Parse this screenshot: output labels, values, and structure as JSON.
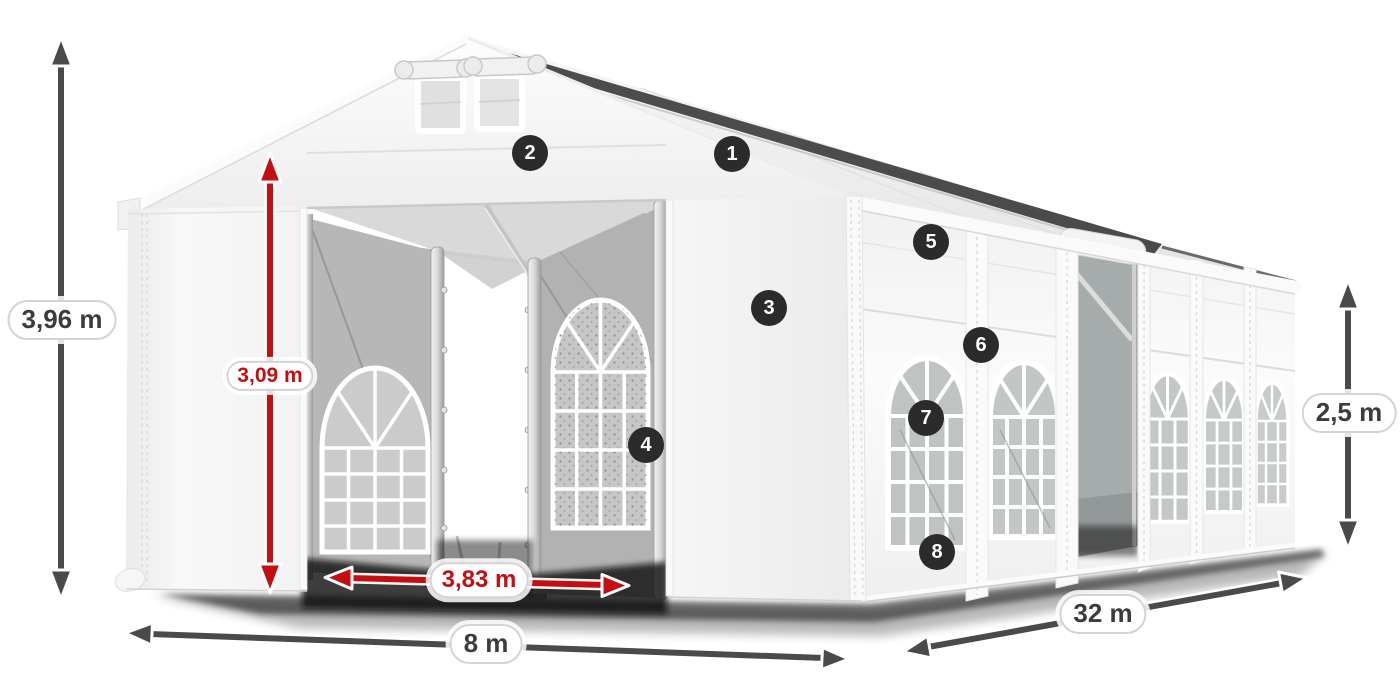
{
  "diagram": {
    "subject": "marquee-tent-dimension-diagram",
    "dimensions": {
      "total_height": "3,96 m",
      "entrance_height": "3,09 m",
      "entrance_width": "3,83 m",
      "front_width": "8 m",
      "side_length": "32 m",
      "side_wall_height": "2,5 m"
    },
    "callouts": [
      "1",
      "2",
      "3",
      "4",
      "5",
      "6",
      "7",
      "8"
    ],
    "colors": {
      "dimension_primary": "#4a4a4a",
      "dimension_accent": "#c40f12",
      "badge_background": "#2b2b2b",
      "badge_text": "#ffffff",
      "label_text": "#3c3c3c",
      "label_background": "#ffffff"
    }
  }
}
